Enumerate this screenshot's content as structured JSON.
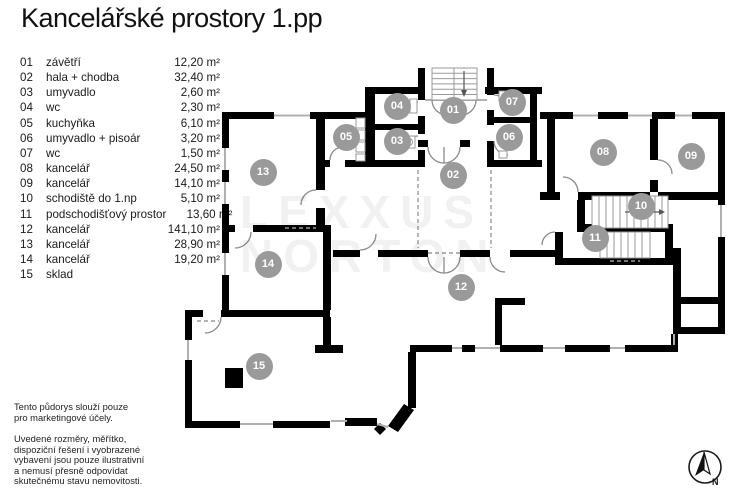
{
  "title": "Kancelářské prostory 1.pp",
  "legend": {
    "rows": [
      {
        "num": "01",
        "label": "závětří",
        "area": "12,20 m²"
      },
      {
        "num": "02",
        "label": "hala + chodba",
        "area": "32,40 m²"
      },
      {
        "num": "03",
        "label": "umyvadlo",
        "area": "2,60 m²"
      },
      {
        "num": "04",
        "label": "wc",
        "area": "2,30 m²"
      },
      {
        "num": "05",
        "label": "kuchyňka",
        "area": "6,10 m²"
      },
      {
        "num": "06",
        "label": "umyvadlo + pisoár",
        "area": "3,20 m²"
      },
      {
        "num": "07",
        "label": "wc",
        "area": "1,50 m²"
      },
      {
        "num": "08",
        "label": "kancelář",
        "area": "24,50 m²"
      },
      {
        "num": "09",
        "label": "kancelář",
        "area": "14,10 m²"
      },
      {
        "num": "10",
        "label": "schodiště do 1.np",
        "area": "5,10 m²"
      },
      {
        "num": "11",
        "label": "podschodišťový prostor",
        "area": "13,60 m²"
      },
      {
        "num": "12",
        "label": "kancelář",
        "area": "141,10 m²"
      },
      {
        "num": "13",
        "label": "kancelář",
        "area": "28,90 m²"
      },
      {
        "num": "14",
        "label": "kancelář",
        "area": "19,20 m²"
      },
      {
        "num": "15",
        "label": "sklad",
        "area": ""
      }
    ]
  },
  "plan": {
    "rooms": [
      {
        "id": "01"
      },
      {
        "id": "02"
      },
      {
        "id": "03"
      },
      {
        "id": "04"
      },
      {
        "id": "05"
      },
      {
        "id": "06"
      },
      {
        "id": "07"
      },
      {
        "id": "08"
      },
      {
        "id": "09"
      },
      {
        "id": "10"
      },
      {
        "id": "11"
      },
      {
        "id": "12"
      },
      {
        "id": "13"
      },
      {
        "id": "14"
      },
      {
        "id": "15"
      }
    ]
  },
  "watermark": {
    "line1": "LEXXUS",
    "line2": "NORTON"
  },
  "disclaimer1": {
    "l1": "Tento půdorys slouží pouze",
    "l2": "pro marketingové účely."
  },
  "disclaimer2": {
    "l1": "Uvedené rozměry, měřítko,",
    "l2": "dispoziční řešení i vyobrazené",
    "l3": "vybavení jsou pouze ilustrativní",
    "l4": "a nemusí přesně odpovídat",
    "l5": "skutečnému stavu nemovitosti."
  },
  "compass": {
    "label": "N"
  },
  "colors": {
    "wall": "#000000",
    "badge": "#9a9a9a",
    "thin_line": "#b0b0b0",
    "door_arc": "#8a8a8a",
    "text": "#1a1a1a"
  }
}
